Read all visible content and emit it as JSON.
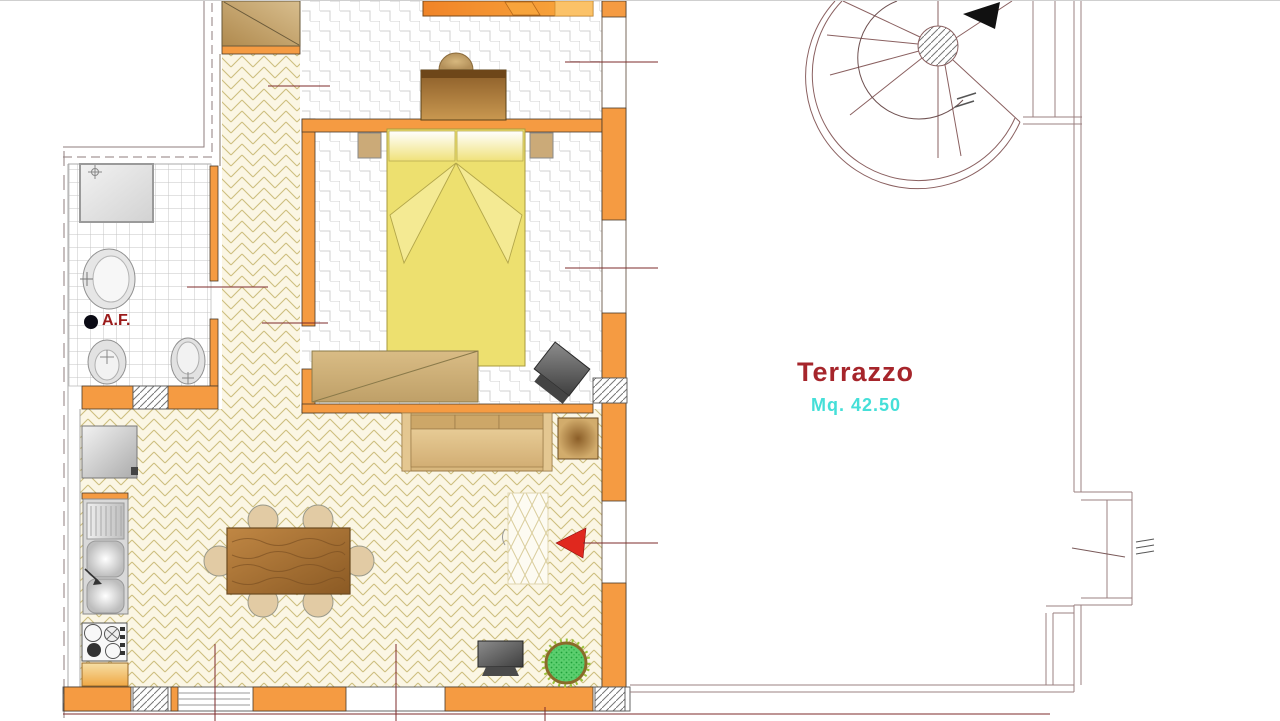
{
  "plan": {
    "terrace": {
      "name": "Terrazzo",
      "area": "Mq. 42.50"
    },
    "bathroom": {
      "cold_water_abbr": "A.F."
    }
  },
  "colors": {
    "wall": "#F59B42",
    "line": "#9B8585",
    "dim": "#7E2B2B",
    "floor_cream": "#FBF6E4",
    "herr_line": "#CDBE7F",
    "zig_line": "#D0D0D0",
    "tile_line": "#C4C4C4",
    "label_red": "#A6252B",
    "label_cyan": "#45DFD8",
    "af_red": "#9B1B1B",
    "arrow_red": "#E0281E",
    "bed": "#EDE06F",
    "plant": "#5BCE6E"
  }
}
